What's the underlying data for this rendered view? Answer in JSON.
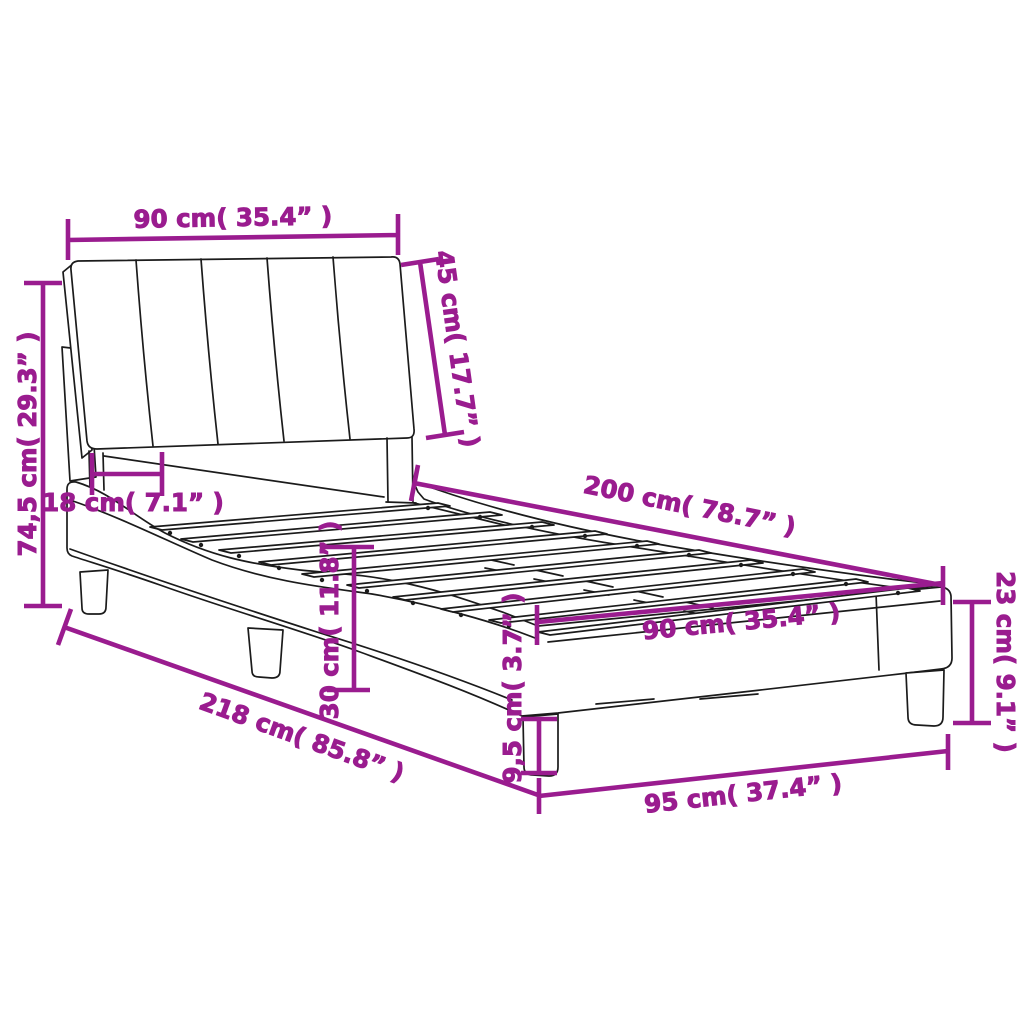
{
  "diagram": {
    "type": "product-dimension-diagram",
    "subject": "bed frame with headboard, slatted base and wave-shaped side rails",
    "background_color": "#ffffff",
    "accent_color": "#9A1C8F",
    "line_color": "#1b1b1b"
  },
  "dims": {
    "headboard_width": {
      "label": "90 cm( 35.4” )"
    },
    "headboard_height": {
      "label": "45 cm( 17.7” )"
    },
    "total_height": {
      "label": "74,5 cm( 29.3” )"
    },
    "headboard_depth": {
      "label": "18 cm( 7.1” )"
    },
    "bed_length": {
      "label": "200 cm( 78.7” )"
    },
    "frame_height": {
      "label": "30 cm( 11.8” )"
    },
    "slat_base_width": {
      "label": "90 cm( 35.4” )"
    },
    "foot_end_height": {
      "label": "23 cm( 9.1” )"
    },
    "leg_height": {
      "label": "9,5 cm( 3.7” )"
    },
    "total_length": {
      "label": "218 cm( 85.8” )"
    },
    "base_width": {
      "label": "95 cm( 37.4” )"
    }
  }
}
